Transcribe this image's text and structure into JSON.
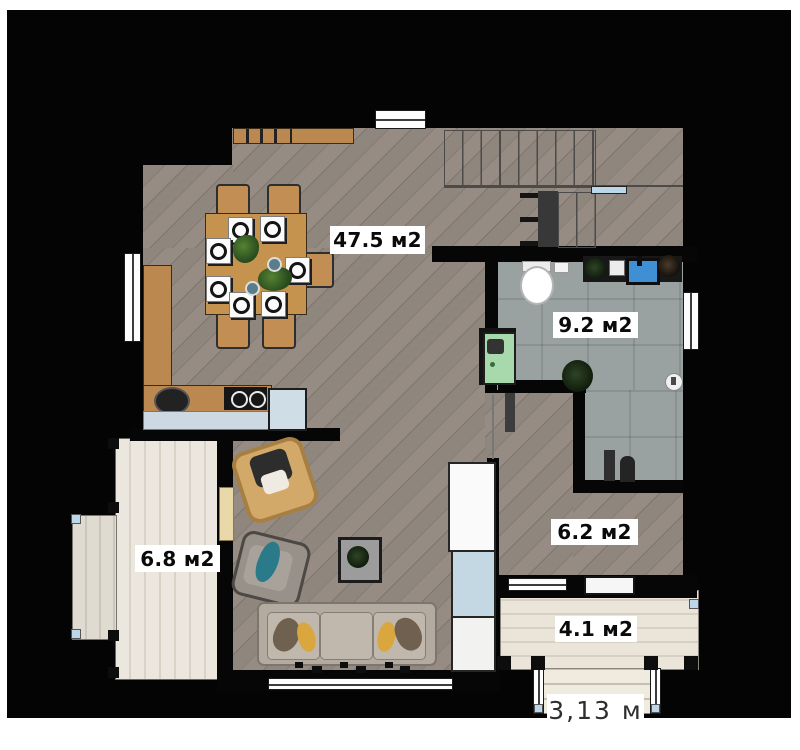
{
  "floor_plan": {
    "rooms": [
      {
        "id": "living-dining-kitchen",
        "label": "47.5 м2"
      },
      {
        "id": "bathroom",
        "label": "9.2 м2"
      },
      {
        "id": "hall",
        "label": "6.2 м2"
      },
      {
        "id": "terrace",
        "label": "6.8 м2"
      },
      {
        "id": "porch",
        "label": "4.1 м2"
      }
    ],
    "dimensions": [
      {
        "id": "porch-steps-width",
        "label": "3,13 м"
      }
    ],
    "colors": {
      "wall": "#060606",
      "wood_floor": "#8b827a",
      "tile_floor": "#9aa2a1",
      "terrace_floor": "#eae5dc",
      "furniture_wood": "#bb8950",
      "sink_blue": "#4a90d9",
      "washer_green": "#a8d9ac",
      "pillow_teal": "#2a7a8a",
      "pillow_yellow": "#d9a73e",
      "handrail_blue": "#bcd7ea"
    }
  }
}
